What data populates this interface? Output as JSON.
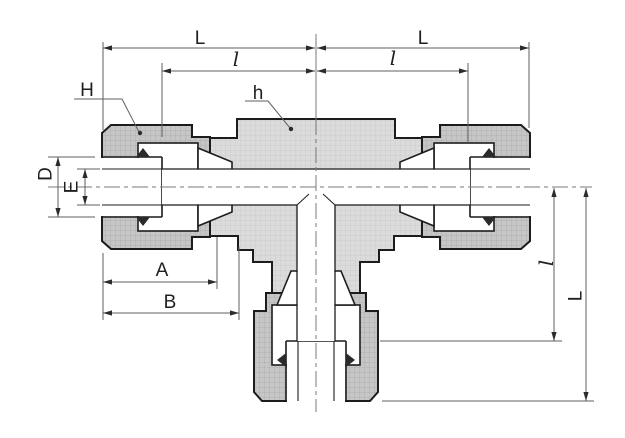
{
  "drawing": {
    "type": "engineering-dimension-drawing",
    "subject": "union tee tube fitting, sectional side view with compression nuts and ferrules",
    "dimension_labels": {
      "overall_left": "L",
      "overall_right": "L",
      "insert_left": "l",
      "insert_right": "l",
      "nut_ref": "H",
      "body_ref": "h",
      "counterbore_dia": "D",
      "bore_dia": "E",
      "nut_length": "A",
      "to_body": "B",
      "branch_insert": "l",
      "branch_overall": "L"
    },
    "colors": {
      "background": "#ffffff",
      "body_fill": "#dbdbdb",
      "nut_fill": "#c6c6c6",
      "part_outline": "#1c1c1c",
      "dimension_lines": "#5f5f5f",
      "centerline": "#7a7a7a",
      "label_text": "#1f1f1f"
    }
  }
}
